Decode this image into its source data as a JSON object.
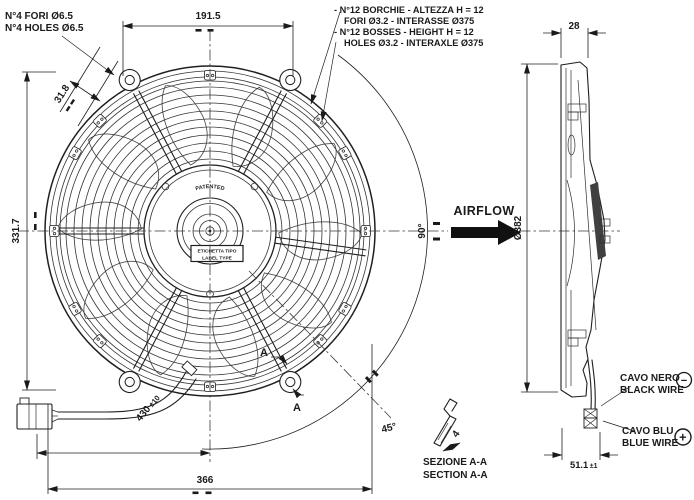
{
  "colors": {
    "line": "#1f1f1f",
    "background": "#ffffff",
    "blade_section_fill": "#404040"
  },
  "notes": {
    "holes": {
      "line1": "N°4 FORI Ø6.5",
      "line2": "N°4 HOLES Ø6.5"
    },
    "bosses": {
      "line1": "- N°12 BORCHIE - ALTEZZA H = 12",
      "line2": "FORI Ø3.2 - INTERASSE Ø375",
      "line3": "- N°12 BOSSES - HEIGHT H = 12",
      "line4": "HOLES Ø3.2 - INTERAXLE Ø375"
    }
  },
  "front_view": {
    "hub_text": "PATENTED",
    "label_box": {
      "line1": "ETICHETTA TIPO",
      "line2": "LABEL TYPE"
    },
    "section_marker": "A"
  },
  "dimensions": {
    "top_hole_spacing": "191.5",
    "hole_offset": "31.8",
    "body_height": "331.7",
    "overall_width": "366",
    "wire_length": "430",
    "wire_length_tol": "±10",
    "angle_right": "90°",
    "angle_bottom": "45°",
    "depth": "28",
    "diameter": "Ø382",
    "total_depth": "51.1",
    "total_depth_tol": "±1",
    "boss_thickness": "4"
  },
  "airflow": {
    "label": "AIRFLOW"
  },
  "wires": {
    "black": {
      "line1": "CAVO NERO",
      "line2": "BLACK WIRE",
      "polarity": "−"
    },
    "blue": {
      "line1": "CAVO BLU",
      "line2": "BLUE WIRE",
      "polarity": "+"
    }
  },
  "section": {
    "title_line1": "SEZIONE A-A",
    "title_line2": "SECTION A-A"
  }
}
